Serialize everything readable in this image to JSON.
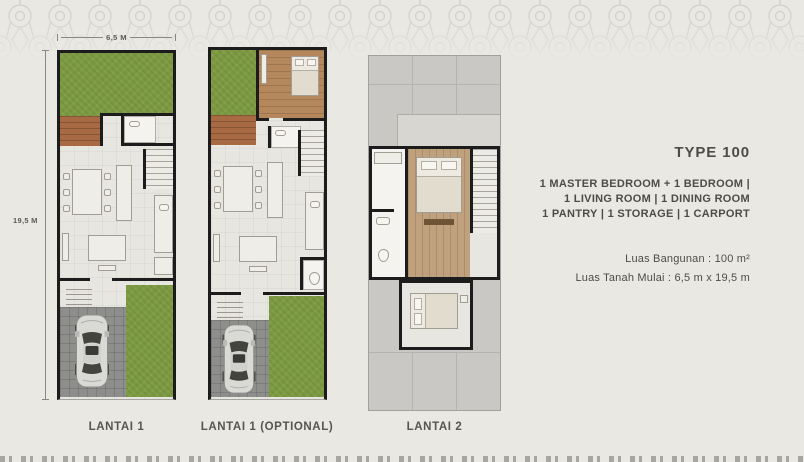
{
  "dimensions": {
    "width_label": "6,5 M",
    "height_label": "19,5 M"
  },
  "plans": [
    {
      "label": "LANTAI 1"
    },
    {
      "label": "LANTAI 1 (OPTIONAL)"
    },
    {
      "label": "LANTAI 2"
    }
  ],
  "info": {
    "type_title": "TYPE 100",
    "rooms_line1": "1 MASTER BEDROOM + 1 BEDROOM |",
    "rooms_line2": "1 LIVING ROOM | 1 DINING ROOM",
    "rooms_line3": "1 PANTRY | 1 STORAGE | 1 CARPORT",
    "area_building": "Luas Bangunan : 100 m²",
    "area_land": "Luas Tanah Mulai : 6,5 m x 19,5 m"
  },
  "colors": {
    "background": "#eae8e3",
    "wall": "#1c1c1c",
    "grass": "#7c9a41",
    "deck_wood": "#a76a42",
    "bedroom_wood": "#c0a17e",
    "roof": "#c9c8c5",
    "carport": "#8e8e8c",
    "text": "#4e4c47"
  }
}
